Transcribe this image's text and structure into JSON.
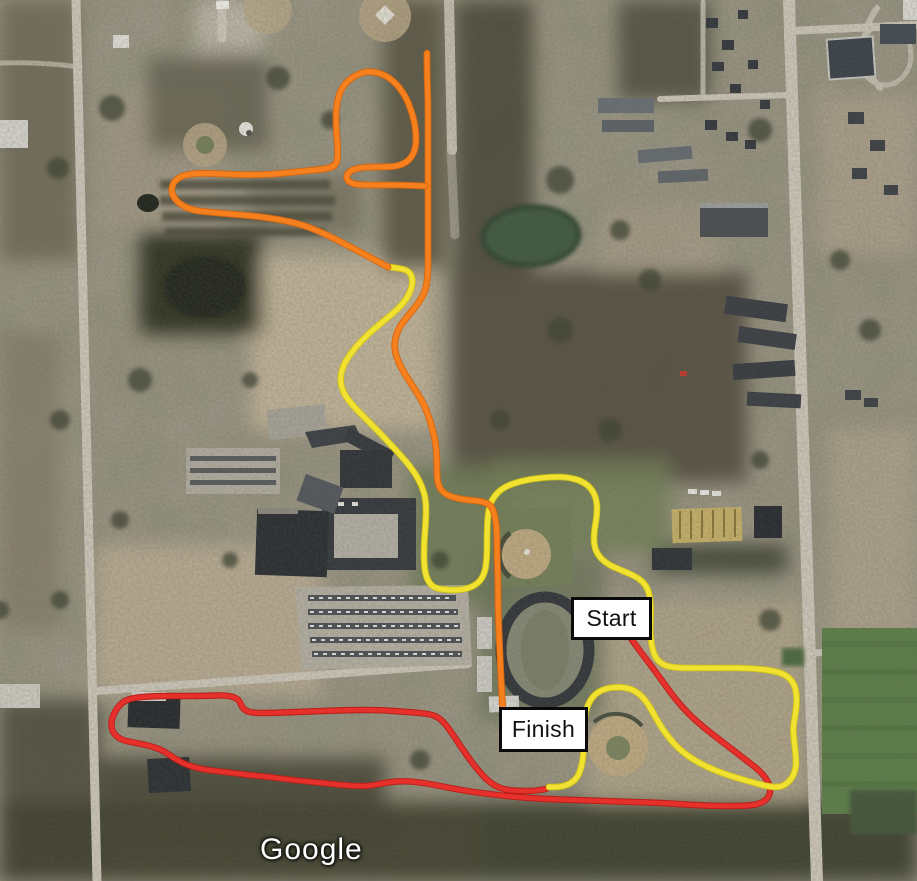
{
  "map": {
    "attribution": "Google",
    "labels": {
      "start": {
        "text": "Start"
      },
      "finish": {
        "text": "Finish"
      }
    },
    "routes": [
      {
        "name": "red-route",
        "color": "#e5302c",
        "edge": "#b81f17",
        "width": 4.6,
        "segments": [
          [
            [
              606,
              602
            ],
            [
              614,
              613
            ],
            [
              624,
              628
            ],
            [
              634,
              643
            ],
            [
              646,
              659
            ],
            [
              658,
              675
            ],
            [
              670,
              692
            ],
            [
              682,
              707
            ],
            [
              696,
              721
            ],
            [
              712,
              734
            ],
            [
              729,
              747
            ],
            [
              746,
              760
            ],
            [
              760,
              771
            ],
            [
              768,
              781
            ],
            [
              771,
              791
            ],
            [
              767,
              800
            ],
            [
              756,
              805
            ],
            [
              740,
              806
            ],
            [
              718,
              806
            ],
            [
              692,
              805
            ],
            [
              664,
              803
            ],
            [
              634,
              802
            ],
            [
              604,
              801
            ],
            [
              574,
              800
            ],
            [
              544,
              799
            ],
            [
              515,
              797
            ],
            [
              489,
              794
            ],
            [
              466,
              791
            ],
            [
              445,
              787
            ],
            [
              425,
              783
            ],
            [
              406,
              781
            ],
            [
              388,
              782
            ],
            [
              370,
              786
            ],
            [
              352,
              786
            ],
            [
              333,
              784
            ],
            [
              313,
              782
            ],
            [
              292,
              780
            ],
            [
              270,
              777
            ],
            [
              248,
              775
            ],
            [
              226,
              772
            ],
            [
              206,
              770
            ],
            [
              189,
              766
            ],
            [
              175,
              759
            ],
            [
              164,
              751
            ],
            [
              151,
              746
            ],
            [
              136,
              743
            ],
            [
              121,
              740
            ],
            [
              112,
              732
            ],
            [
              111,
              721
            ],
            [
              116,
              709
            ],
            [
              125,
              700
            ],
            [
              139,
              697
            ],
            [
              159,
              696
            ],
            [
              181,
              696
            ],
            [
              205,
              696
            ],
            [
              227,
              695
            ],
            [
              239,
              699
            ],
            [
              242,
              708
            ],
            [
              250,
              713
            ],
            [
              271,
              713
            ],
            [
              296,
              712
            ],
            [
              322,
              711
            ],
            [
              350,
              710
            ],
            [
              379,
              710
            ],
            [
              409,
              712
            ],
            [
              431,
              714
            ],
            [
              441,
              719
            ],
            [
              450,
              730
            ],
            [
              459,
              744
            ],
            [
              468,
              757
            ],
            [
              477,
              769
            ],
            [
              486,
              779
            ],
            [
              495,
              786
            ],
            [
              506,
              790
            ],
            [
              520,
              791
            ],
            [
              534,
              791
            ],
            [
              546,
              789
            ]
          ]
        ]
      },
      {
        "name": "yellow-route",
        "color": "#f1e232",
        "edge": "#cfc215",
        "width": 4.8,
        "segments": [
          [
            [
              388,
              267
            ],
            [
              399,
              268
            ],
            [
              409,
              271
            ],
            [
              413,
              279
            ],
            [
              411,
              291
            ],
            [
              403,
              304
            ],
            [
              390,
              316
            ],
            [
              375,
              328
            ],
            [
              361,
              341
            ],
            [
              350,
              354
            ],
            [
              342,
              368
            ],
            [
              340,
              382
            ],
            [
              344,
              394
            ],
            [
              353,
              406
            ],
            [
              364,
              417
            ],
            [
              378,
              431
            ],
            [
              392,
              446
            ],
            [
              405,
              460
            ],
            [
              415,
              473
            ],
            [
              422,
              486
            ],
            [
              426,
              500
            ],
            [
              426,
              519
            ],
            [
              424,
              543
            ],
            [
              424,
              566
            ],
            [
              427,
              580
            ],
            [
              434,
              588
            ],
            [
              447,
              590
            ],
            [
              464,
              590
            ],
            [
              478,
              584
            ],
            [
              485,
              573
            ],
            [
              487,
              556
            ],
            [
              487,
              532
            ],
            [
              488,
              512
            ],
            [
              492,
              499
            ],
            [
              501,
              489
            ],
            [
              514,
              483
            ],
            [
              531,
              479
            ],
            [
              550,
              477
            ],
            [
              567,
              477
            ],
            [
              582,
              481
            ],
            [
              592,
              489
            ],
            [
              597,
              501
            ],
            [
              597,
              516
            ],
            [
              594,
              532
            ],
            [
              594,
              546
            ],
            [
              599,
              557
            ],
            [
              609,
              565
            ],
            [
              623,
              571
            ],
            [
              637,
              577
            ],
            [
              646,
              585
            ],
            [
              650,
              596
            ],
            [
              651,
              613
            ],
            [
              650,
              631
            ],
            [
              652,
              648
            ],
            [
              656,
              659
            ],
            [
              665,
              666
            ],
            [
              679,
              668
            ],
            [
              698,
              668
            ],
            [
              722,
              668
            ],
            [
              747,
              668
            ],
            [
              769,
              670
            ],
            [
              785,
              674
            ],
            [
              794,
              683
            ],
            [
              797,
              696
            ],
            [
              796,
              712
            ],
            [
              793,
              726
            ],
            [
              794,
              741
            ],
            [
              796,
              756
            ],
            [
              796,
              769
            ],
            [
              791,
              780
            ],
            [
              782,
              787
            ],
            [
              770,
              787
            ],
            [
              755,
              783
            ],
            [
              737,
              778
            ],
            [
              716,
              771
            ],
            [
              697,
              762
            ],
            [
              681,
              751
            ],
            [
              668,
              737
            ],
            [
              658,
              722
            ],
            [
              650,
              707
            ],
            [
              642,
              696
            ],
            [
              632,
              689
            ],
            [
              620,
              687
            ],
            [
              607,
              688
            ],
            [
              596,
              693
            ],
            [
              589,
              702
            ],
            [
              585,
              714
            ],
            [
              584,
              731
            ],
            [
              584,
              749
            ],
            [
              582,
              765
            ],
            [
              578,
              777
            ],
            [
              570,
              784
            ],
            [
              560,
              787
            ],
            [
              549,
              787
            ]
          ]
        ]
      },
      {
        "name": "orange-route",
        "color": "#f5801d",
        "edge": "#d4650e",
        "width": 5,
        "segments": [
          [
            [
              503,
              714
            ],
            [
              502,
              697
            ],
            [
              501,
              678
            ],
            [
              500,
              656
            ],
            [
              499,
              632
            ],
            [
              498,
              606
            ],
            [
              498,
              580
            ],
            [
              497,
              554
            ],
            [
              497,
              532
            ],
            [
              495,
              515
            ],
            [
              491,
              505
            ],
            [
              481,
              501
            ],
            [
              466,
              500
            ],
            [
              451,
              497
            ],
            [
              441,
              491
            ],
            [
              437,
              481
            ],
            [
              437,
              463
            ],
            [
              436,
              444
            ],
            [
              431,
              423
            ],
            [
              424,
              404
            ],
            [
              414,
              388
            ],
            [
              404,
              373
            ],
            [
              397,
              359
            ],
            [
              394,
              346
            ],
            [
              397,
              331
            ],
            [
              406,
              318
            ],
            [
              418,
              304
            ],
            [
              426,
              290
            ],
            [
              428,
              272
            ],
            [
              428,
              250
            ],
            [
              428,
              225
            ],
            [
              428,
              200
            ],
            [
              428,
              184
            ],
            [
              428,
              160
            ],
            [
              428,
              130
            ],
            [
              428,
              100
            ],
            [
              427,
              73
            ],
            [
              427,
              53
            ]
          ],
          [
            [
              388,
              267
            ],
            [
              377,
              261
            ],
            [
              360,
              252
            ],
            [
              341,
              242
            ],
            [
              321,
              232
            ],
            [
              300,
              224
            ],
            [
              277,
              219
            ],
            [
              254,
              216
            ],
            [
              230,
              214
            ],
            [
              208,
              212
            ],
            [
              191,
              210
            ],
            [
              178,
              203
            ],
            [
              171,
              193
            ],
            [
              173,
              182
            ],
            [
              183,
              175
            ],
            [
              200,
              173
            ],
            [
              224,
              174
            ],
            [
              250,
              175
            ],
            [
              277,
              174
            ],
            [
              304,
              171
            ],
            [
              326,
              169
            ],
            [
              337,
              165
            ],
            [
              338,
              150
            ],
            [
              336,
              128
            ],
            [
              336,
              106
            ],
            [
              341,
              88
            ],
            [
              352,
              77
            ],
            [
              366,
              71
            ],
            [
              381,
              73
            ],
            [
              394,
              81
            ],
            [
              405,
              95
            ],
            [
              412,
              112
            ],
            [
              416,
              130
            ],
            [
              416,
              148
            ],
            [
              410,
              160
            ],
            [
              399,
              166
            ],
            [
              384,
              167
            ],
            [
              367,
              167
            ],
            [
              353,
              169
            ],
            [
              346,
              175
            ],
            [
              348,
              182
            ],
            [
              358,
              185
            ],
            [
              377,
              185
            ],
            [
              400,
              185
            ],
            [
              425,
              186
            ]
          ]
        ]
      }
    ]
  }
}
